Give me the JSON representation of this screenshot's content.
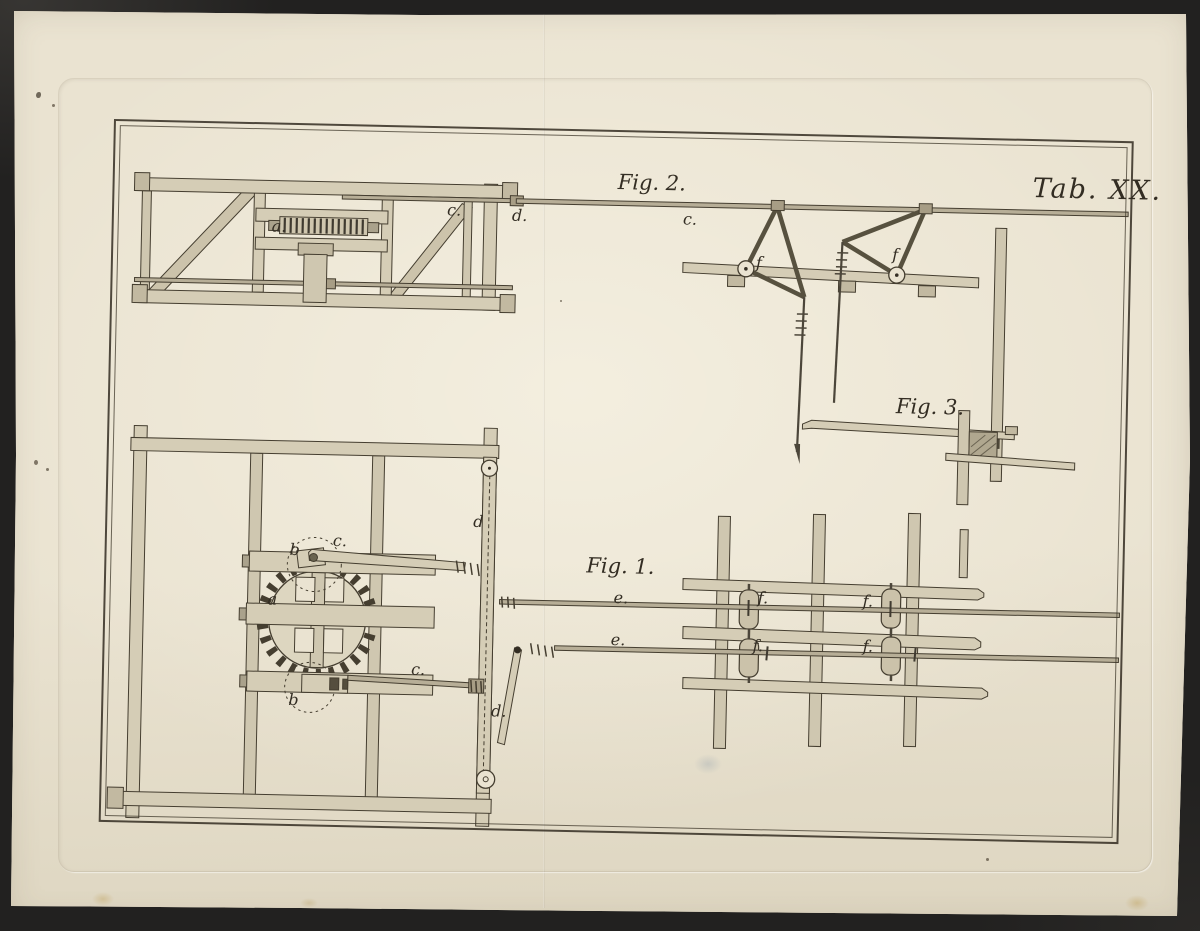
{
  "document": {
    "type": "engraved-technical-plate",
    "description": "Antique engraving plate of rod-and-lever transmission machinery, three figures"
  },
  "theme": {
    "bg": "#222120",
    "paper": "#eae3d1",
    "ink": "#332d23",
    "wood": "#d5cdb6",
    "rod": "#b7ae97"
  },
  "plate": {
    "title": "Tab. XX.",
    "figures": [
      {
        "id": "fig1",
        "label": "Fig. 1."
      },
      {
        "id": "fig2",
        "label": "Fig. 2."
      },
      {
        "id": "fig3",
        "label": "Fig. 3."
      }
    ],
    "part_labels": [
      {
        "ref": "fig2-crown-gear",
        "text": "a.",
        "x": 160,
        "y": 96
      },
      {
        "ref": "fig2-crank-rod",
        "text": "c.",
        "x": 335,
        "y": 76
      },
      {
        "ref": "fig2-link",
        "text": "d.",
        "x": 400,
        "y": 80
      },
      {
        "ref": "fig2-long-rod",
        "text": "c.",
        "x": 571,
        "y": 80
      },
      {
        "ref": "fig2-left-bellcrank",
        "text": "f",
        "x": 645,
        "y": 122
      },
      {
        "ref": "fig2-right-bellcrank",
        "text": "f",
        "x": 781,
        "y": 111
      },
      {
        "ref": "fig1-gear-wheel",
        "text": "a",
        "x": 164,
        "y": 469
      },
      {
        "ref": "fig1-top-lever",
        "text": "b",
        "x": 185,
        "y": 419
      },
      {
        "ref": "fig1-top-rod",
        "text": "c.",
        "x": 228,
        "y": 409
      },
      {
        "ref": "fig1-guide-bar",
        "text": "d",
        "x": 368,
        "y": 387
      },
      {
        "ref": "fig1-upper-rod",
        "text": "e.",
        "x": 510,
        "y": 460
      },
      {
        "ref": "fig1-lower-rod",
        "text": "e.",
        "x": 508,
        "y": 502
      },
      {
        "ref": "fig1-bottom-lever",
        "text": "b",
        "x": 187,
        "y": 569
      },
      {
        "ref": "fig1-bottom-rod",
        "text": "c.",
        "x": 309,
        "y": 536
      },
      {
        "ref": "fig1-diagonal-link",
        "text": "d.",
        "x": 390,
        "y": 576
      },
      {
        "ref": "roller-upper-left",
        "text": "f.",
        "x": 654,
        "y": 457
      },
      {
        "ref": "roller-lower-left",
        "text": "f.",
        "x": 650,
        "y": 505
      },
      {
        "ref": "roller-upper-right",
        "text": "f.",
        "x": 759,
        "y": 458
      },
      {
        "ref": "roller-lower-right",
        "text": "f.",
        "x": 760,
        "y": 503
      }
    ]
  }
}
